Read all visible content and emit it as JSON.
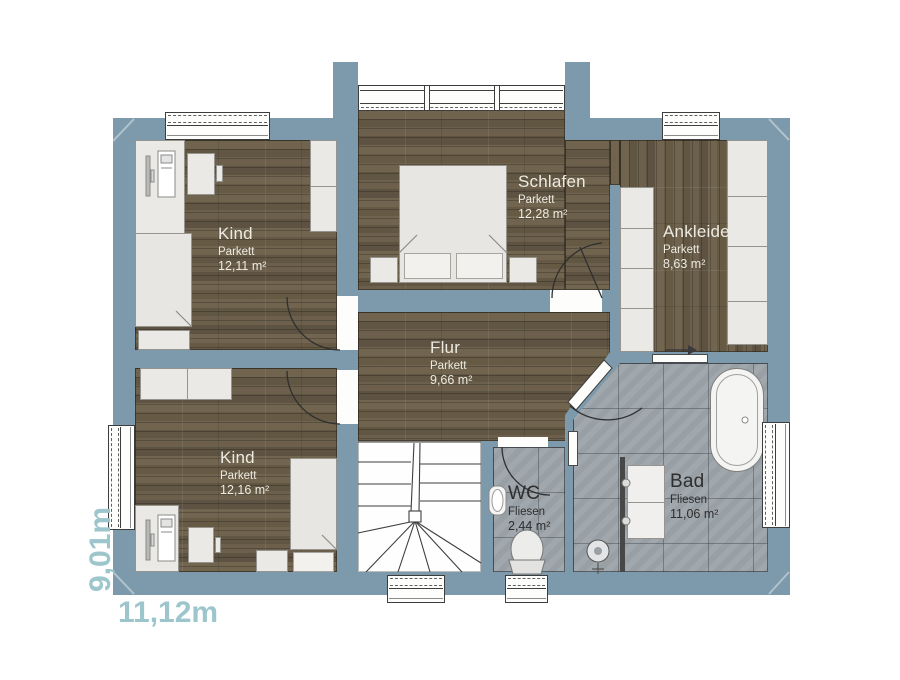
{
  "plan": {
    "dimension_width_label": "11,12m",
    "dimension_height_label": "9,01m"
  },
  "rooms": [
    {
      "name": "Kind",
      "floor_type": "Parkett",
      "area": "12,11 m²"
    },
    {
      "name": "Schlafen",
      "floor_type": "Parkett",
      "area": "12,28 m²"
    },
    {
      "name": "Ankleide",
      "floor_type": "Parkett",
      "area": "8,63 m²"
    },
    {
      "name": "Flur",
      "floor_type": "Parkett",
      "area": "9,66 m²"
    },
    {
      "name": "Kind",
      "floor_type": "Parkett",
      "area": "12,16 m²"
    },
    {
      "name": "WC",
      "floor_type": "Fliesen",
      "area": "2,44 m²"
    },
    {
      "name": "Bad",
      "floor_type": "Fliesen",
      "area": "11,06 m²"
    }
  ],
  "colors": {
    "wall": "#7c9aab",
    "parquet": "#6a5e4b",
    "tile": "#9da4aa",
    "dimension_text": "#9cc6cc"
  }
}
